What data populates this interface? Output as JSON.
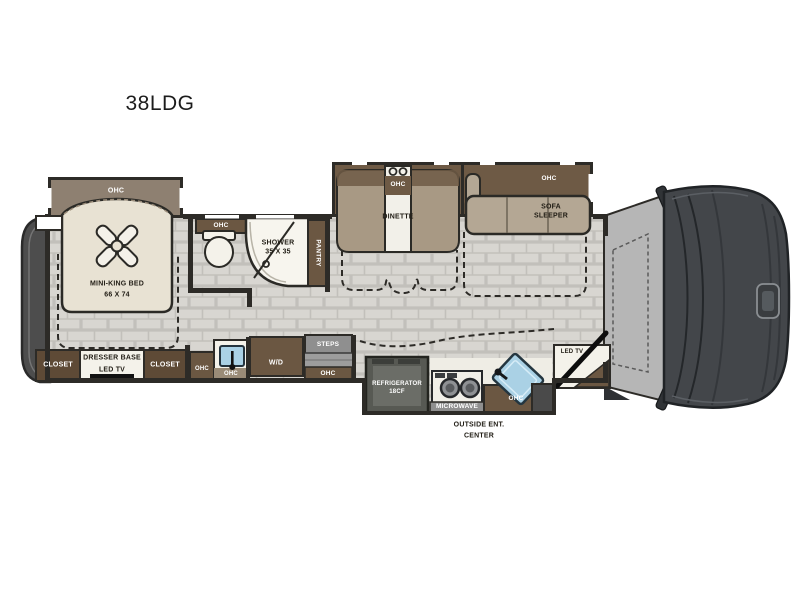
{
  "title": "38LDG",
  "colors": {
    "wall": "#2d2b27",
    "floor_tile": "#d8d6d1",
    "grout": "#c2c0bb",
    "cabinet_brown": "#6b5742",
    "cabinet_dark_brown": "#5e4a36",
    "ohc_taupe": "#8e8071",
    "bench_taupe": "#a89984",
    "sofa_taupe": "#b4a794",
    "bed_cream": "#e8e2d3",
    "white_fixture": "#f4f2ea",
    "steps_gray": "#8f8f8f",
    "fridge_gray": "#575953",
    "sink_blue": "#aad1e5",
    "cab_dark": "#43464a",
    "cockpit_gray": "#b6b6b6",
    "rear_cap": "#4d4d4d"
  },
  "labels": {
    "bedroom": {
      "ohc": "OHC",
      "bed_name": "MINI-KING BED",
      "bed_size": "66 X 74",
      "closet_left": "CLOSET",
      "closet_right": "CLOSET",
      "dresser": "DRESSER BASE",
      "dresser_tv": "LED TV"
    },
    "bath": {
      "ohc": "OHC",
      "shower_name": "SHOWER",
      "shower_size": "35 X 35",
      "pantry": "PANTRY"
    },
    "hall": {
      "ohc_cabinet": "OHC",
      "ohc_sink": "OHC",
      "washer_dryer": "W/D",
      "steps": "STEPS",
      "steps_ohc": "OHC"
    },
    "dinette": {
      "ohc": "OHC",
      "name": "DINETTE"
    },
    "sofa": {
      "ohc": "OHC",
      "name_line1": "SOFA",
      "name_line2": "SLEEPER"
    },
    "kitchen": {
      "fridge_line1": "REFRIGERATOR",
      "fridge_line2": "18CF",
      "microwave": "MICROWAVE",
      "ohc": "OHC",
      "outside_line1": "OUTSIDE ENT.",
      "outside_line2": "CENTER"
    },
    "entry": {
      "tv": "LED TV"
    }
  }
}
